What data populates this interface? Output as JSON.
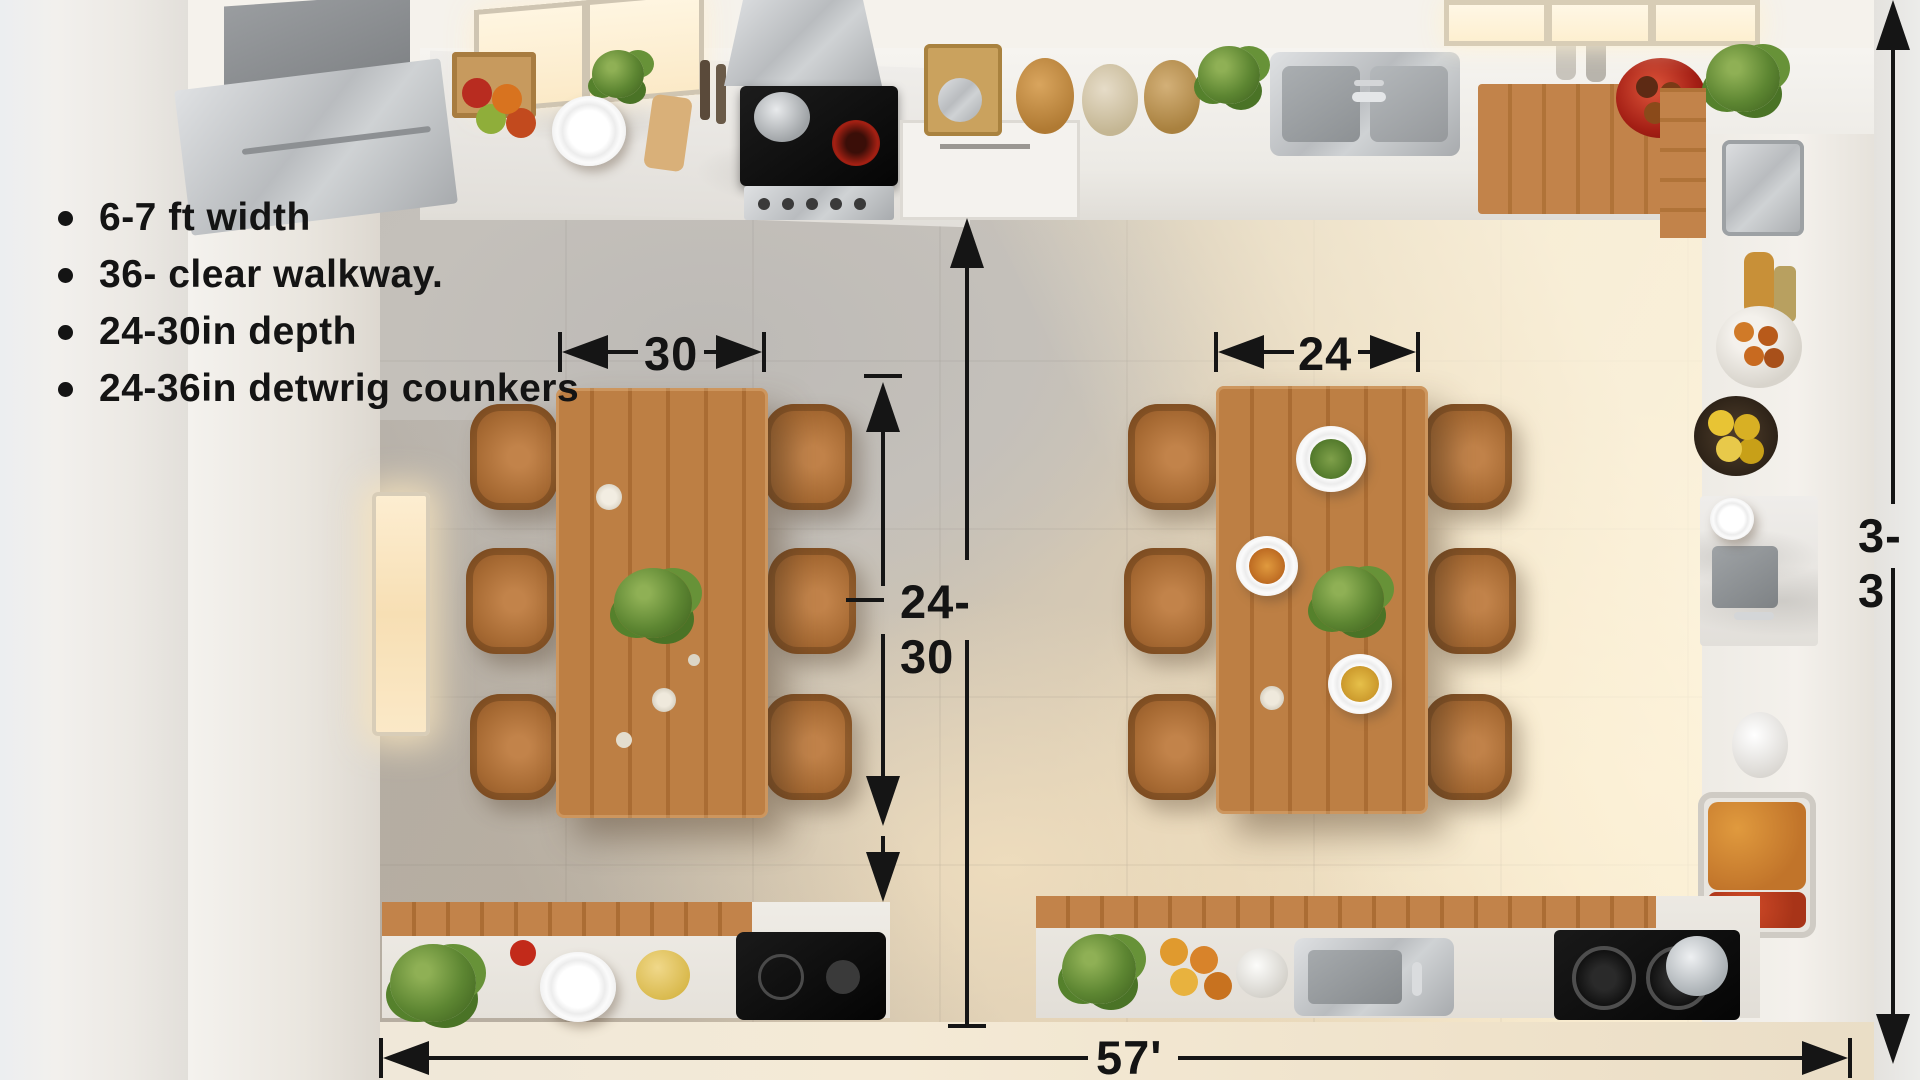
{
  "annotations": {
    "bullets": [
      {
        "label": "6-7 ft width"
      },
      {
        "label": "36- clear walkway."
      },
      {
        "label": "24-30in depth"
      },
      {
        "label": "24-36in detwrig counkers"
      }
    ],
    "dimensions": {
      "left_table_width": "30",
      "right_table_width": "24",
      "walkway_clearance": "24-30",
      "room_width": "57'",
      "right_edge_clearance": "3-3"
    }
  },
  "colors": {
    "annotation_ink": "#151515",
    "table_wood": "#b5763c",
    "floor_tile_gray": "#c2beb8",
    "floor_sunlit": "#f0e0c2",
    "counter_white": "#f2f0ec",
    "red_bowl": "#b3271d",
    "lemon_yellow": "#e8c434"
  }
}
